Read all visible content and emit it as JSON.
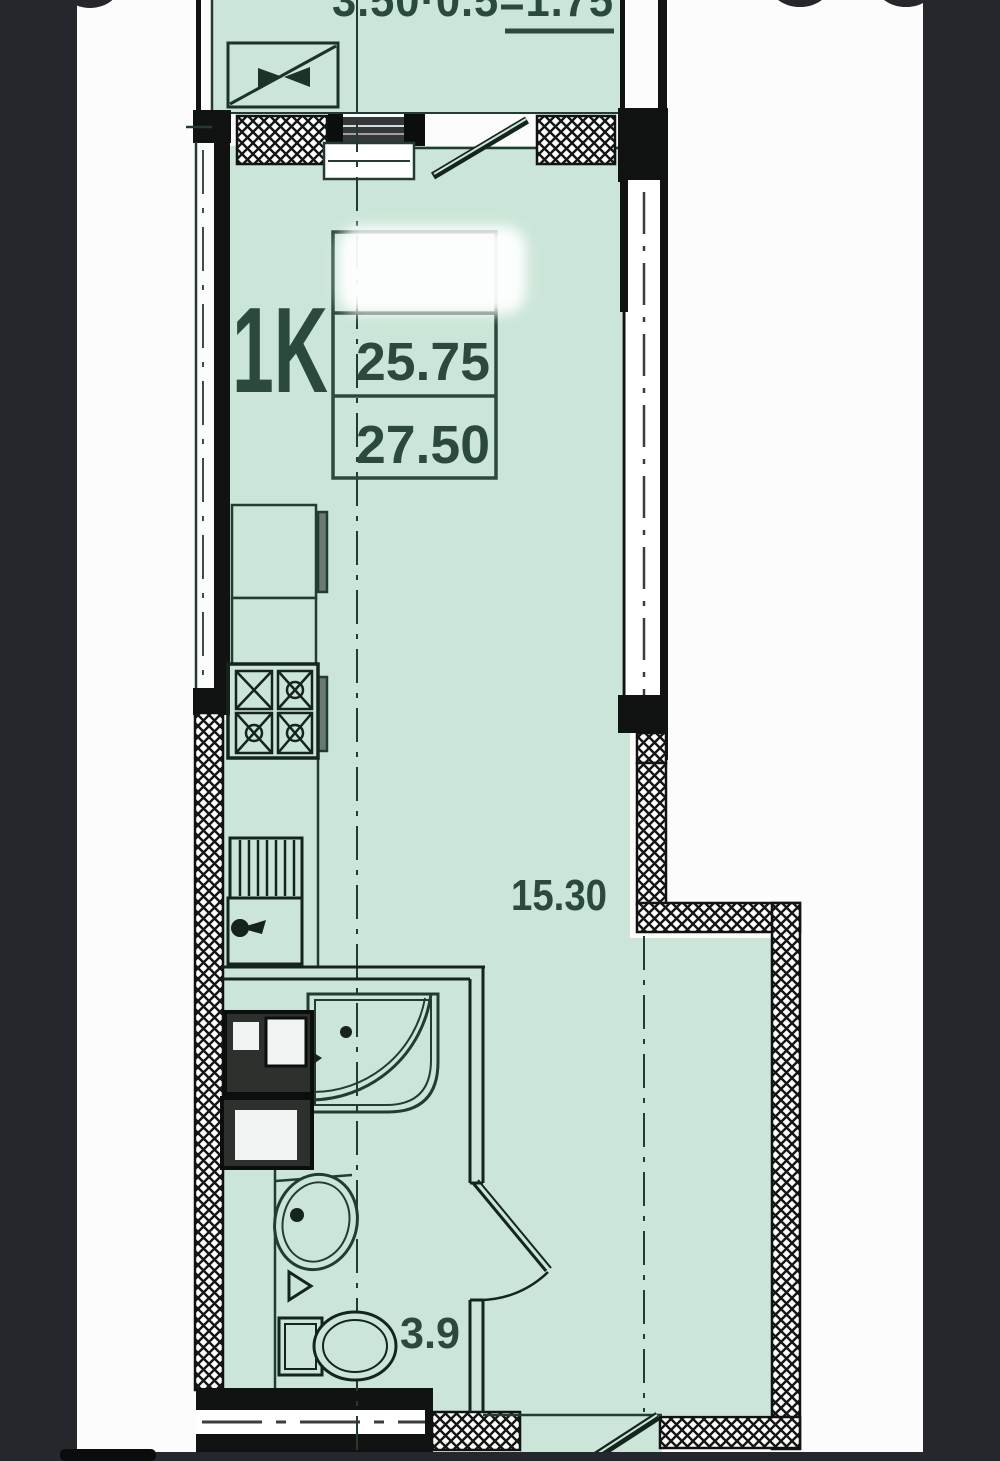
{
  "plan": {
    "unit_type_label": "1K",
    "living_area_value": "25.75",
    "total_area_value": "27.50",
    "room_area_label": "15.30",
    "bathroom_area_label": "3.9",
    "balcony_area_formula": "3.50·0.5=1.75"
  },
  "colors": {
    "background": "#26272c",
    "paper": "#fcfcfc",
    "room_fill": "#cbe6d8",
    "thin_line": "#233c31",
    "wall": "#111312",
    "text": "#2b4a3c"
  }
}
